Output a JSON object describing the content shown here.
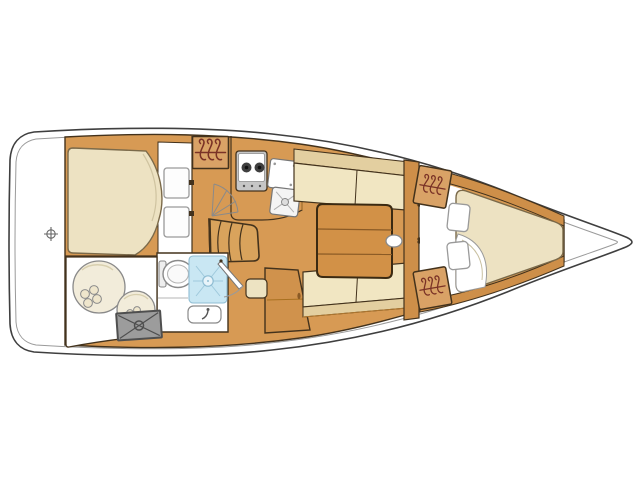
{
  "canvas": {
    "width": 640,
    "height": 480,
    "background": "#ffffff"
  },
  "diagram": {
    "kind": "sailboat-interior-floor-plan",
    "orientation": "bow-right",
    "components": [
      "hull-outline",
      "stern-transom",
      "deck-fitting",
      "aft-cabin-double-berth",
      "aft-cabin-cushions",
      "aft-hanging-locker",
      "galley-stove",
      "galley-sink-lid",
      "galley-sink",
      "companionway-steps",
      "aft-cabin-door-swing",
      "head-toilet",
      "head-shower",
      "head-washbasin",
      "head-door",
      "stern-storage-locker",
      "fenders",
      "engine-hatch",
      "nav-cabinet",
      "nav-seat",
      "saloon-table",
      "mast-post",
      "port-settee",
      "starboard-settee",
      "forward-bulkhead",
      "forward-cabin-double-doors",
      "forward-hanging-lockers",
      "v-berth-mattress",
      "v-berth-pillows",
      "bow-deck"
    ]
  },
  "colors": {
    "background": "#ffffff",
    "hull_outline": "#3f3f3f",
    "inner_line": "#9a9a9a",
    "floor": "#D79A54",
    "wood_dark": "#CE8F49",
    "table_wood": "#D29147",
    "steps_wood": "#D9A35C",
    "outline_dark": "#43321c",
    "cushion": "#F1E6C2",
    "backrest": "#E3CFA0",
    "mattress": "#EDE2C2",
    "locker_tan": "#D9A266",
    "hanger_stroke": "#7a3226",
    "shower_blue": "#C9E7F3",
    "shower_line": "#8FBDD3",
    "stove_burner": "#3f3f3f",
    "gray_box": "#9C9C9C",
    "gray_box_border": "#4f4f4f",
    "fender": "#F2ECDA",
    "white": "#ffffff"
  }
}
